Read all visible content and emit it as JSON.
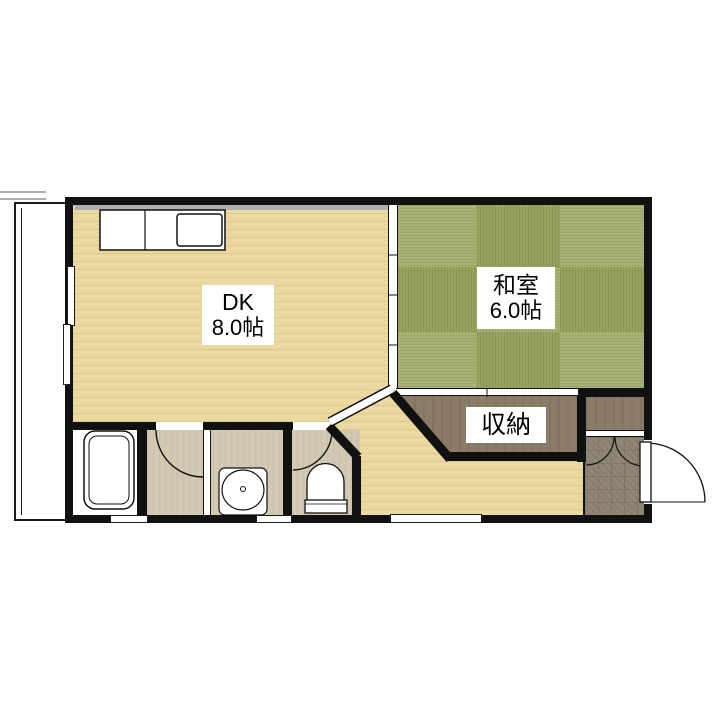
{
  "theme": {
    "wood": "#ebd9a1",
    "tatami-light": "#a9b273",
    "tatami-dark": "#98a35f",
    "taupe": "#d3c8b2",
    "closet": "#8a7c66",
    "tile": "#8c8170",
    "wall": "#111111",
    "paper": "#ffffff"
  },
  "floorplan": {
    "rooms": {
      "dk": {
        "name": "DK",
        "size": "8.0帖"
      },
      "washitsu": {
        "name": "和室",
        "size": "6.0帖"
      },
      "closet": {
        "name": "収納"
      }
    },
    "fixtures": [
      "balcony",
      "kitchen-counter-with-sink",
      "sliding-window",
      "bathtub",
      "washbasin",
      "toilet",
      "entrance-door",
      "shoe-cabinet",
      "genkan-tile",
      "sliding-partition",
      "storage-closet"
    ]
  }
}
